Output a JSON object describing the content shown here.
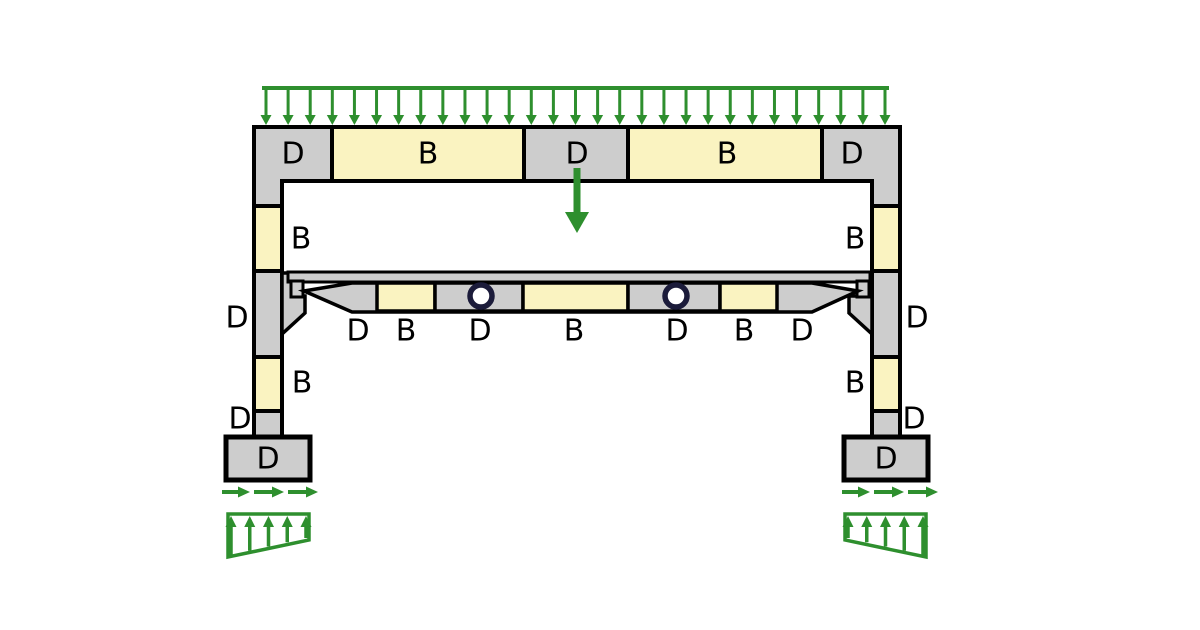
{
  "title": "B-region and D-region layout of a precast concrete frame",
  "colors": {
    "background": "#ffffff",
    "outline": "#000000",
    "d_region_fill": "#cdcdcd",
    "b_region_fill": "#faf3c1",
    "load_green": "#2e8f2e",
    "hole_ring": "#1b1b3a"
  },
  "legend": {
    "d_means": "D-region (discontinuity)",
    "b_means": "B-region (Bernoulli)"
  },
  "labels": {
    "top_beam": [
      "D",
      "B",
      "D",
      "B",
      "D"
    ],
    "left_column": [
      "B",
      "D",
      "B",
      "D"
    ],
    "left_footing": "D",
    "right_column": [
      "B",
      "D",
      "B",
      "D"
    ],
    "right_footing": "D",
    "lower_beam": [
      "D",
      "B",
      "D",
      "B",
      "D",
      "B",
      "D"
    ]
  },
  "lower_beam": {
    "hole_count": 2
  },
  "loads": {
    "distributed_top": {
      "x_start": 262,
      "x_end": 889,
      "y_line": 88,
      "y_tip": 125,
      "arrow_count": 29
    },
    "point_load": {
      "x": 577,
      "y_start": 168,
      "y_tip": 233
    },
    "left_shear_arrows": {
      "y": 492,
      "segments": [
        [
          222,
          250
        ],
        [
          254,
          284
        ],
        [
          288,
          318
        ]
      ]
    },
    "right_shear_arrows": {
      "y": 492,
      "segments": [
        [
          842,
          870
        ],
        [
          874,
          904
        ],
        [
          908,
          938
        ]
      ]
    },
    "left_soil_pressure": {
      "x_start": 228,
      "x_end": 309,
      "y_top": 514,
      "y_bottom_left": 557,
      "y_bottom_right": 540,
      "arrow_count": 5
    },
    "right_soil_pressure": {
      "x_start": 845,
      "x_end": 926,
      "y_top": 514,
      "y_bottom_left": 540,
      "y_bottom_right": 557,
      "arrow_count": 5
    }
  }
}
